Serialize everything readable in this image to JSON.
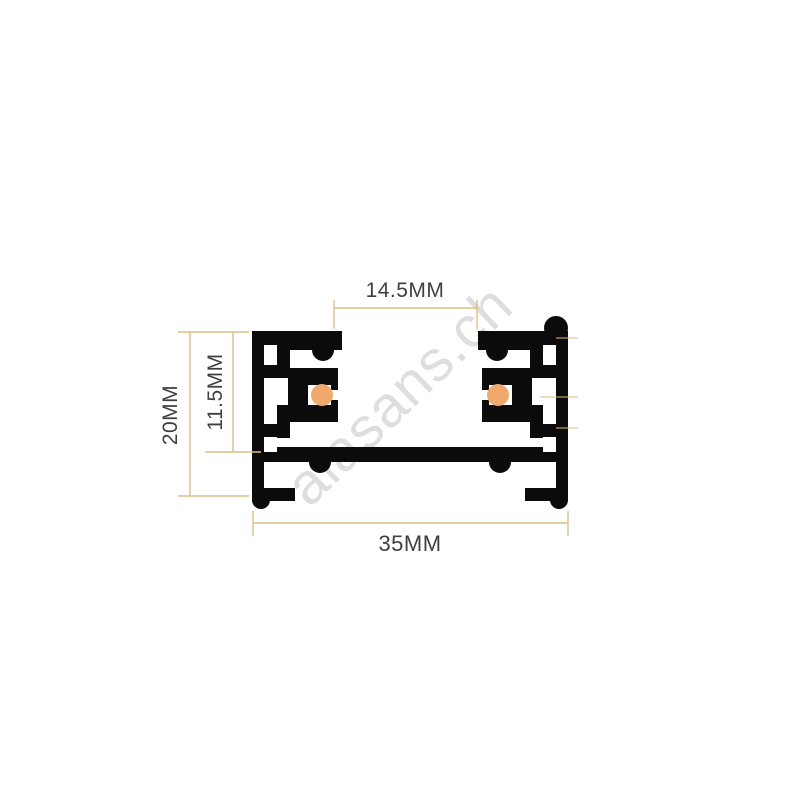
{
  "dimensions": {
    "slot_width": {
      "label": "14.5MM"
    },
    "overall_height": {
      "label": "20MM"
    },
    "inner_height": {
      "label": "11.5MM"
    },
    "overall_width": {
      "label": "35MM"
    }
  },
  "watermark": {
    "text": "alasans.ch"
  },
  "colors": {
    "background": "#ffffff",
    "profile": "#0b0b0b",
    "conductor": "#f2a96e",
    "dimline": "#ddbe85",
    "label": "#3f3f3f",
    "watermark": "#c4c4c4"
  }
}
